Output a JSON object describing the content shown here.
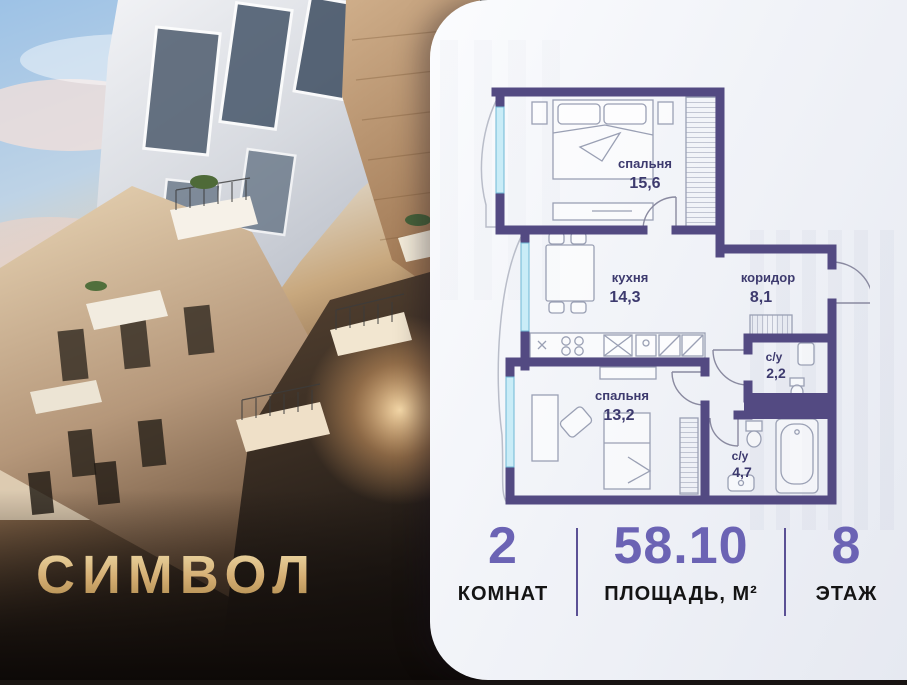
{
  "logo": {
    "text": "СИМВОЛ"
  },
  "floor_plan": {
    "rooms": [
      {
        "name": "спальня",
        "area": "15,6"
      },
      {
        "name": "кухня",
        "area": "14,3"
      },
      {
        "name": "коридор",
        "area": "8,1"
      },
      {
        "name": "с/у",
        "area": "2,2"
      },
      {
        "name": "спальня",
        "area": "13,2"
      },
      {
        "name": "с/у",
        "area": "4,7"
      }
    ]
  },
  "stats": [
    {
      "value": "2",
      "label": "КОМНАТ"
    },
    {
      "value": "58.10",
      "label": "ПЛОЩАДЬ, М²"
    },
    {
      "value": "8",
      "label": "ЭТАЖ"
    }
  ],
  "colors": {
    "wall": "#534a82",
    "accent_number": "#6b63b4",
    "plan_label": "#3d3a6e",
    "logo_gold": "#d4ad72",
    "window_glass": "#c9ecf7"
  }
}
